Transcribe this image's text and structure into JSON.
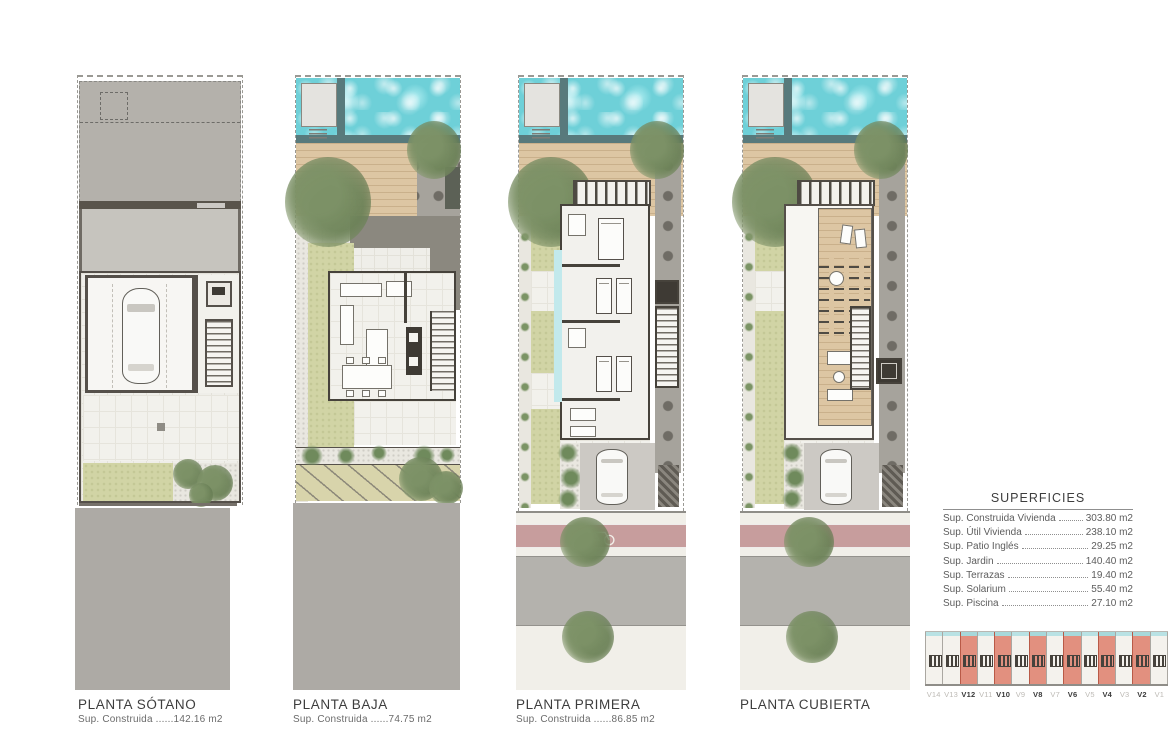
{
  "page": {
    "background": "#ffffff"
  },
  "plans": [
    {
      "id": "sotano",
      "title": "PLANTA SÓTANO",
      "subtitle": "Sup. Construida ......142.16 m2"
    },
    {
      "id": "baja",
      "title": "PLANTA BAJA",
      "subtitle": "Sup. Construida ......74.75 m2"
    },
    {
      "id": "primera",
      "title": "PLANTA PRIMERA",
      "subtitle": "Sup. Construida ......86.85 m2"
    },
    {
      "id": "cubierta",
      "title": "PLANTA CUBIERTA",
      "subtitle": ""
    }
  ],
  "superficies": {
    "title": "SUPERFICIES",
    "rows": [
      {
        "label": "Sup. Construida Vivienda",
        "value": "303.80 m2"
      },
      {
        "label": "Sup. Útil Vivienda",
        "value": "238.10 m2"
      },
      {
        "label": "Sup. Patio Inglés",
        "value": "29.25 m2"
      },
      {
        "label": "Sup. Jardin",
        "value": "140.40 m2"
      },
      {
        "label": "Sup. Terrazas",
        "value": "19.40 m2"
      },
      {
        "label": "Sup. Solarium",
        "value": "55.40 m2"
      },
      {
        "label": "Sup. Piscina",
        "value": "27.10 m2"
      }
    ]
  },
  "keyplan": {
    "units": [
      {
        "label": "V14",
        "highlighted": false
      },
      {
        "label": "V13",
        "highlighted": false
      },
      {
        "label": "V12",
        "highlighted": true
      },
      {
        "label": "V11",
        "highlighted": false
      },
      {
        "label": "V10",
        "highlighted": true
      },
      {
        "label": "V9",
        "highlighted": false
      },
      {
        "label": "V8",
        "highlighted": true
      },
      {
        "label": "V7",
        "highlighted": false
      },
      {
        "label": "V6",
        "highlighted": true
      },
      {
        "label": "V5",
        "highlighted": false
      },
      {
        "label": "V4",
        "highlighted": true
      },
      {
        "label": "V3",
        "highlighted": false
      },
      {
        "label": "V2",
        "highlighted": true
      },
      {
        "label": "V1",
        "highlighted": false
      }
    ]
  },
  "colors": {
    "pool": "#6ed0d8",
    "deck": "#ddc6a3",
    "lawn": "#d1d4a5",
    "street": "#adaaa5",
    "bike_lane": "#c79d9d",
    "highlight_unit": "#e2907f"
  }
}
